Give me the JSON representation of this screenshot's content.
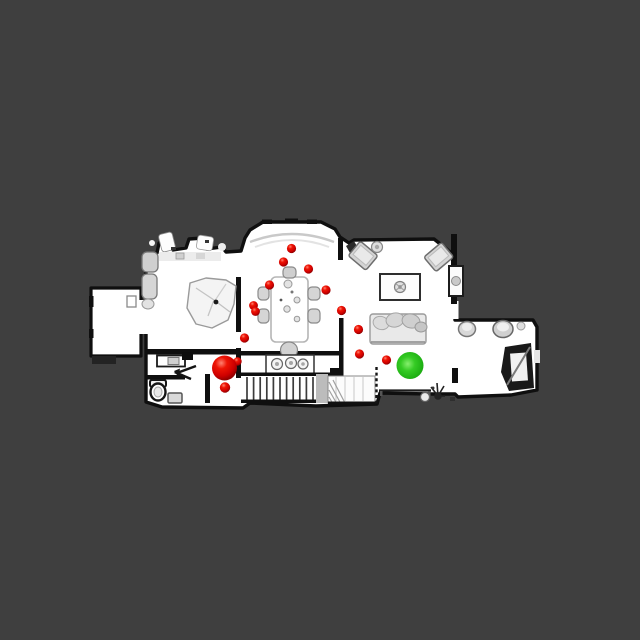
{
  "scene": {
    "view": "top-down 3D scan of a residential floor",
    "background_color": "#3f3f3f",
    "floor_color": "#ffffff",
    "wall_color": "#0f0f0f",
    "furniture_color": "#d6d6d6"
  },
  "markers": {
    "goal": {
      "x": 410,
      "y": 365.5,
      "r": 13.5,
      "color": "#2fc324"
    },
    "start": {
      "x": 224.5,
      "y": 368,
      "r": 12.5,
      "color": "#e01000"
    },
    "waypoints": {
      "color": "#e01000",
      "points": [
        {
          "x": 291.5,
          "y": 248.5,
          "r": 4.6
        },
        {
          "x": 283.5,
          "y": 262.0,
          "r": 4.6
        },
        {
          "x": 308.5,
          "y": 269.0,
          "r": 4.6
        },
        {
          "x": 269.5,
          "y": 285.0,
          "r": 4.6
        },
        {
          "x": 326.0,
          "y": 290.0,
          "r": 4.6
        },
        {
          "x": 253.5,
          "y": 305.5,
          "r": 4.4
        },
        {
          "x": 255.5,
          "y": 311.5,
          "r": 4.4
        },
        {
          "x": 341.5,
          "y": 310.5,
          "r": 4.6
        },
        {
          "x": 358.5,
          "y": 329.5,
          "r": 4.6
        },
        {
          "x": 244.5,
          "y": 338.0,
          "r": 4.6
        },
        {
          "x": 359.5,
          "y": 354.0,
          "r": 4.6
        },
        {
          "x": 386.5,
          "y": 360.0,
          "r": 4.6
        },
        {
          "x": 237.5,
          "y": 361.5,
          "r": 4.2
        },
        {
          "x": 225.0,
          "y": 387.5,
          "r": 5.2
        }
      ]
    }
  }
}
